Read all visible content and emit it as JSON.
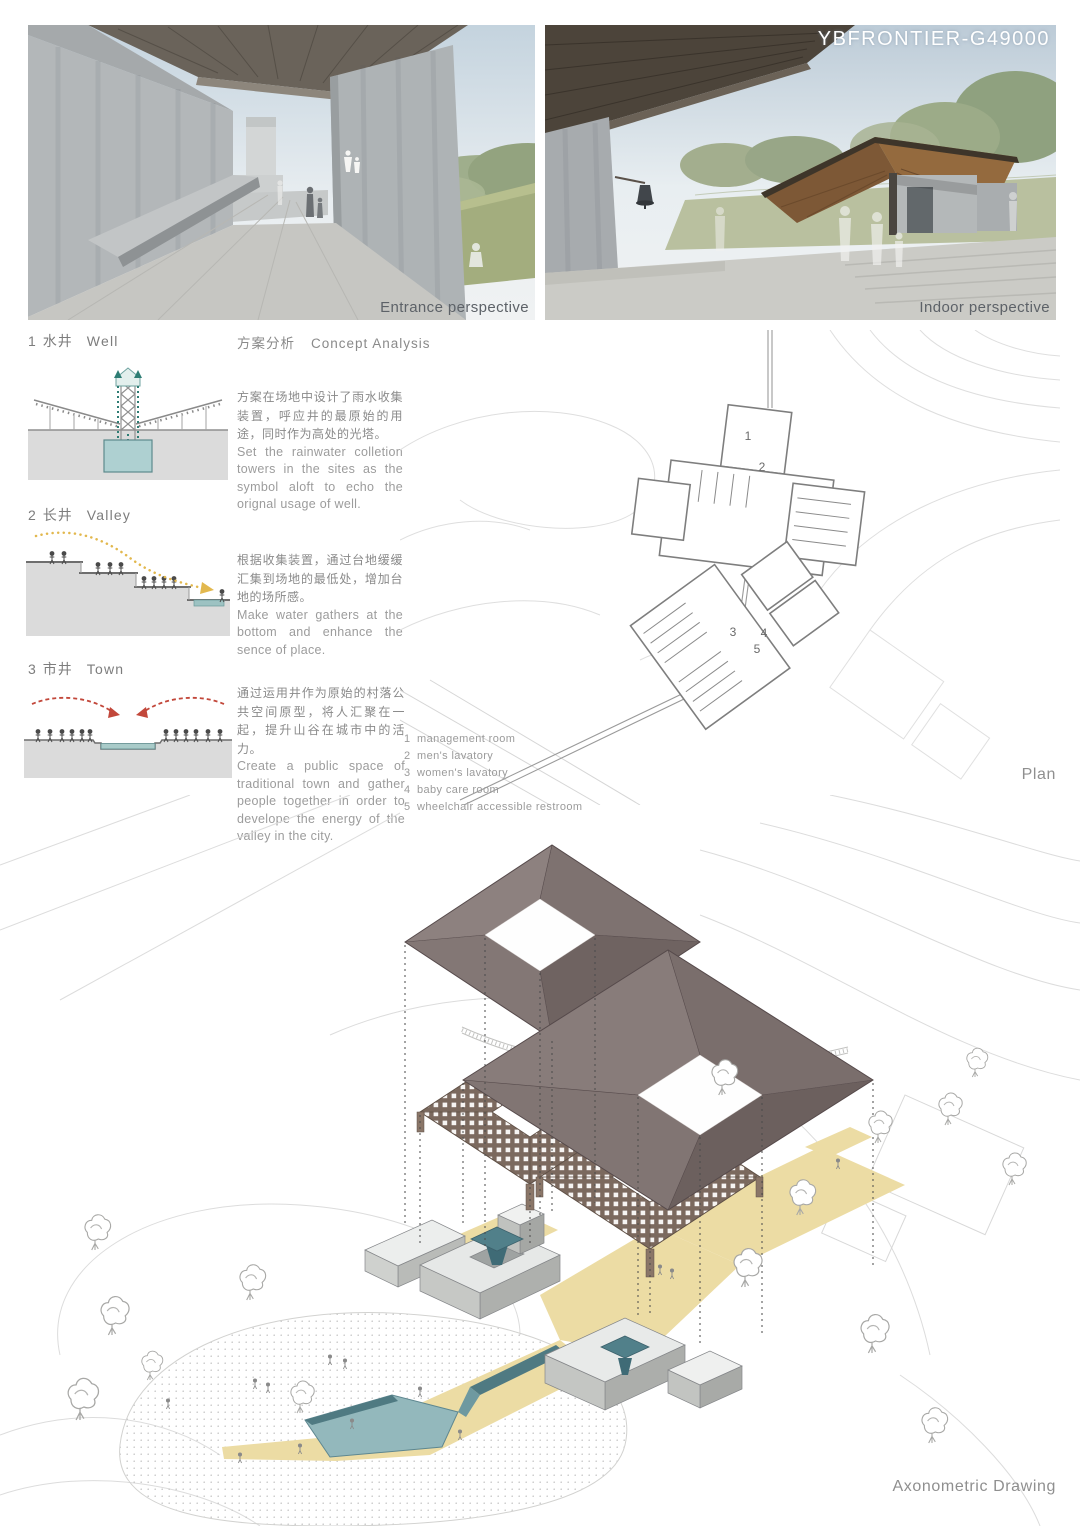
{
  "board": {
    "title": "YBFRONTIER-G49000"
  },
  "renders": {
    "entrance_label": "Entrance perspective",
    "indoor_label": "Indoor perspective"
  },
  "concept": {
    "header_zh": "方案分析",
    "header_en": "Concept Analysis",
    "sections": [
      {
        "num": "1",
        "title_zh": "水井",
        "title_en": "Well",
        "body_zh": "方案在场地中设计了雨水收集装置，呼应井的最原始的用途，同时作为高处的光塔。",
        "body_en": "Set the rainwater colletion towers in the sites as the symbol aloft to echo the orignal usage of well."
      },
      {
        "num": "2",
        "title_zh": "长井",
        "title_en": "Valley",
        "body_zh": "根据收集装置，通过台地缓缓汇集到场地的最低处，增加台地的场所感。",
        "body_en": "Make water gathers at the bottom and enhance the sence of place."
      },
      {
        "num": "3",
        "title_zh": "市井",
        "title_en": "Town",
        "body_zh": "通过运用井作为原始的村落公共空间原型，将人汇聚在一起，提升山谷在城市中的活力。",
        "body_en": "Create a public space of traditional town and gather people together in order to develope the energy of the valley in the city."
      }
    ]
  },
  "plan": {
    "label": "Plan",
    "rooms": [
      "1",
      "2",
      "3",
      "4",
      "5"
    ],
    "legend": [
      {
        "num": "1",
        "label": "management room"
      },
      {
        "num": "2",
        "label": "men's lavatory"
      },
      {
        "num": "3",
        "label": "women's lavatory"
      },
      {
        "num": "4",
        "label": "baby care room"
      },
      {
        "num": "5",
        "label": "wheelchair accessible restroom"
      }
    ]
  },
  "axon": {
    "label": "Axonometric Drawing"
  },
  "colors": {
    "roof_taupe": "#7c706e",
    "lattice_brown": "#7b695e",
    "path_yellow": "#ecdca4",
    "water_teal": "#93b8bc",
    "diagram_teal": "#2e7d74",
    "arrow_yellow": "#e2b84e",
    "arrow_red": "#c2473a",
    "ground_gray": "#dbdbdb",
    "label_gray": "#8f8f8f"
  }
}
